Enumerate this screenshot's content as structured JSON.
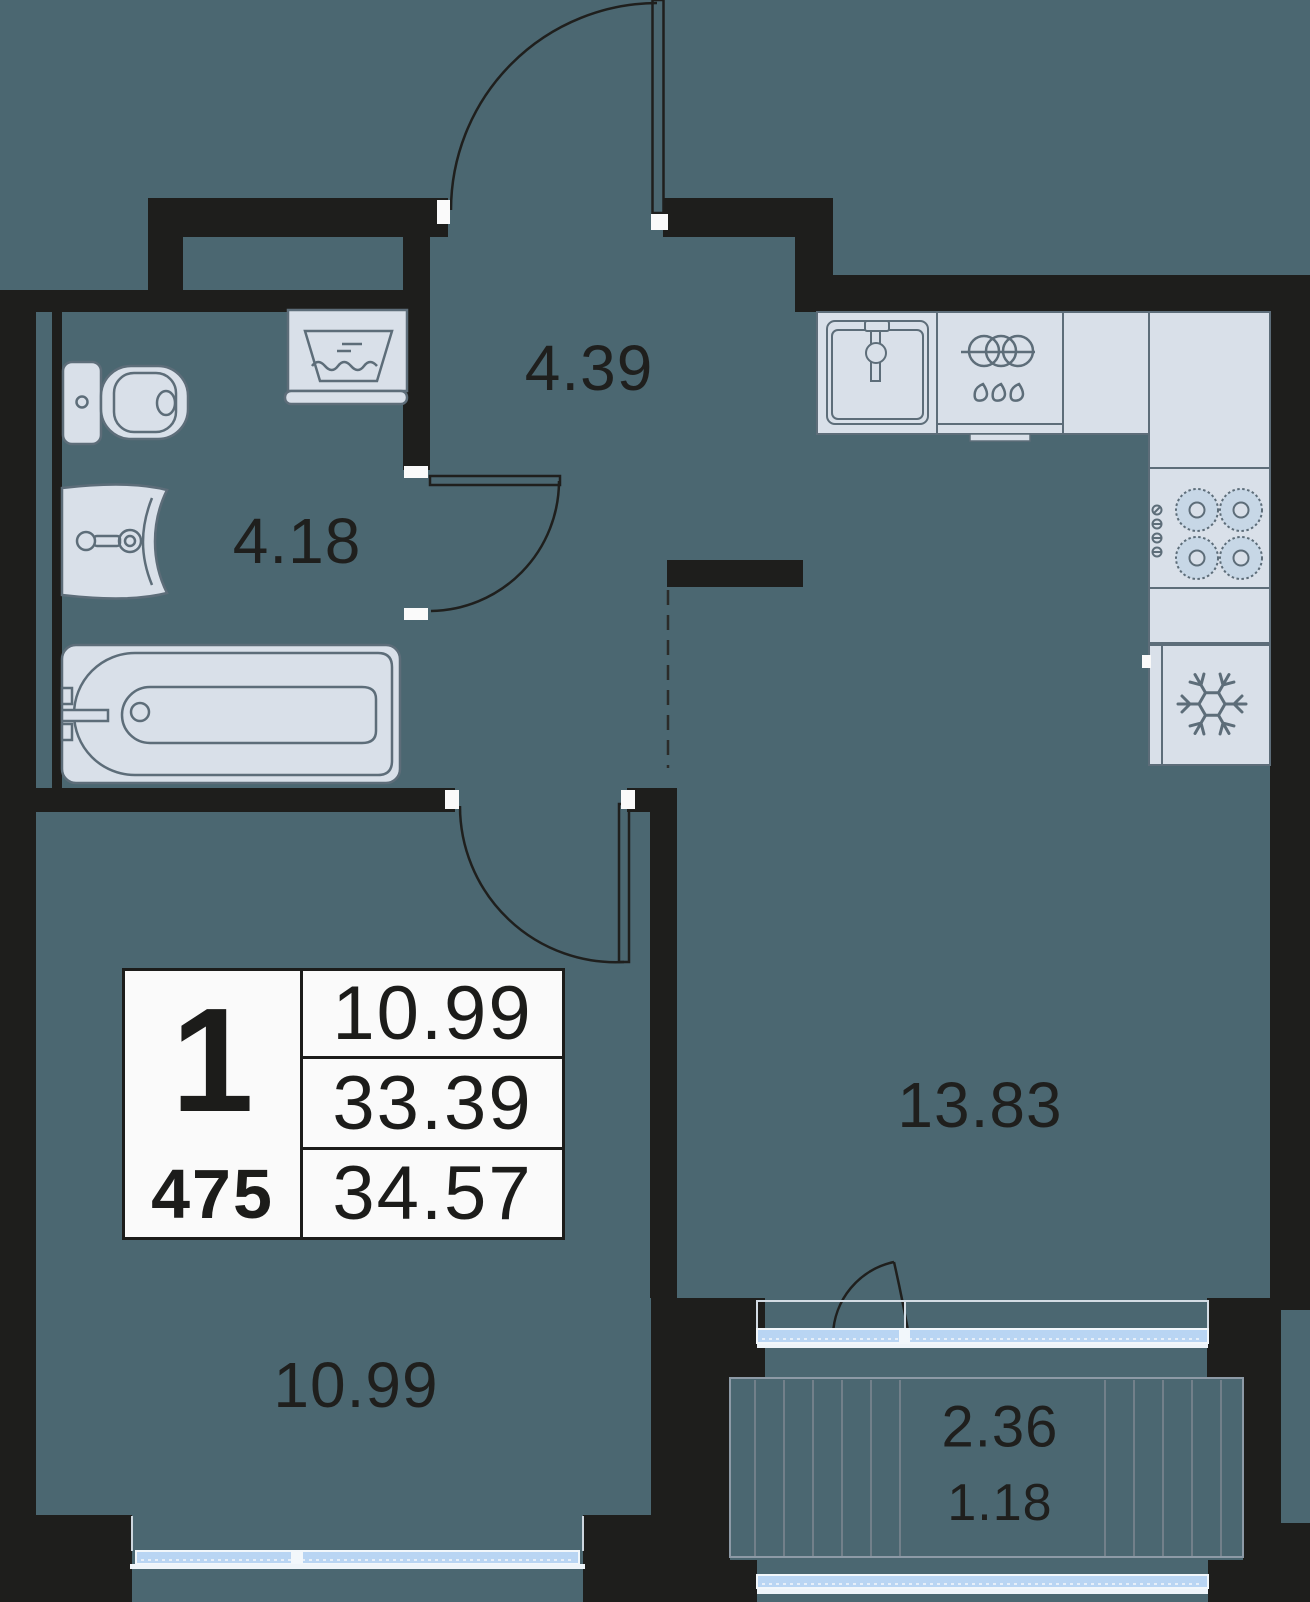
{
  "plan": {
    "hallway_area": "4.39",
    "bathroom_area": "4.18",
    "kitchen_living_area": "13.83",
    "bedroom_area": "10.99",
    "balcony_area": "2.36",
    "balcony_reduced_area": "1.18"
  },
  "info_table": {
    "rooms_count": "1",
    "apartment_number": "475",
    "living_area": "10.99",
    "area_without_balcony": "33.39",
    "total_area": "34.57"
  },
  "colors": {
    "floor": "#4b6771",
    "walls": "#1e1e1c",
    "fixture_fill": "#d9e0e9",
    "fixture_stroke": "#5d6d79",
    "glazing_blue": "#b9d5f3",
    "table_background": "#fafafa",
    "text": "#1f1f1d"
  },
  "icons": {
    "toilet-icon": "svg-shape",
    "washbasin-icon": "svg-shape",
    "bathtub-icon": "svg-shape",
    "washing-machine-icon": "svg-shape",
    "kitchen-sink-icon": "svg-shape",
    "dishwasher-icon": "svg-shape",
    "stove-burners-icon": "svg-shape",
    "fridge-snowflake-icon": "svg-shape",
    "door-swing-arc": "svg-shape",
    "balcony-hatch": "svg-shape"
  }
}
